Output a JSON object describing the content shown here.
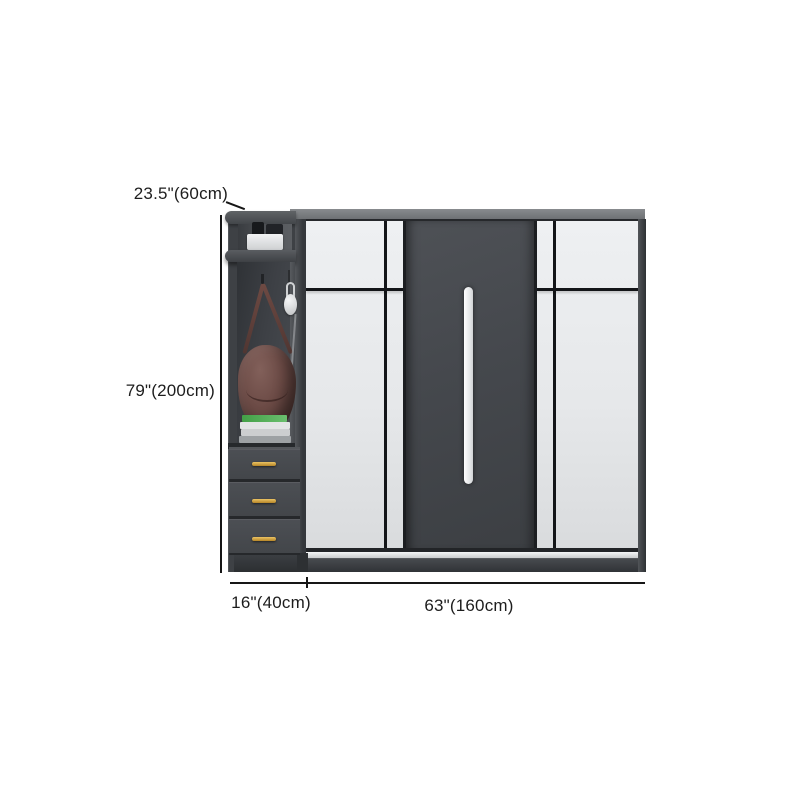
{
  "image": {
    "description": "Modern two-tone gray wardrobe with sliding doors and attached side open-shelf cabinet with three drawers, annotated with product dimensions",
    "background_color": "#ffffff"
  },
  "annotations": {
    "depth_label": "23.5\"(60cm)",
    "height_label": "79\"(200cm)",
    "side_width_label": "16\"(40cm)",
    "main_width_label": "63\"(160cm)"
  },
  "palette": {
    "frame_dark_gray": "#36393d",
    "door_white": "#e9ebed",
    "door_dark_gray": "#46494e",
    "top_surface_gray": "#7b7e82",
    "center_handle_white": "#f4f5f6",
    "drawer_handle_gold": "#c89a3c",
    "bag_leather_brown": "#6b4a45",
    "book_green": "#4caf50",
    "annotation_text": "#1d1d1d"
  },
  "decor_items": {
    "shelf_items": "dark boxes and white storage box on top shelf",
    "hanging_bag": "brown leather shoulder bag on hook",
    "hanging_headphones": "white headphones on hook",
    "book_stack": "stack of books, green cover on top"
  }
}
